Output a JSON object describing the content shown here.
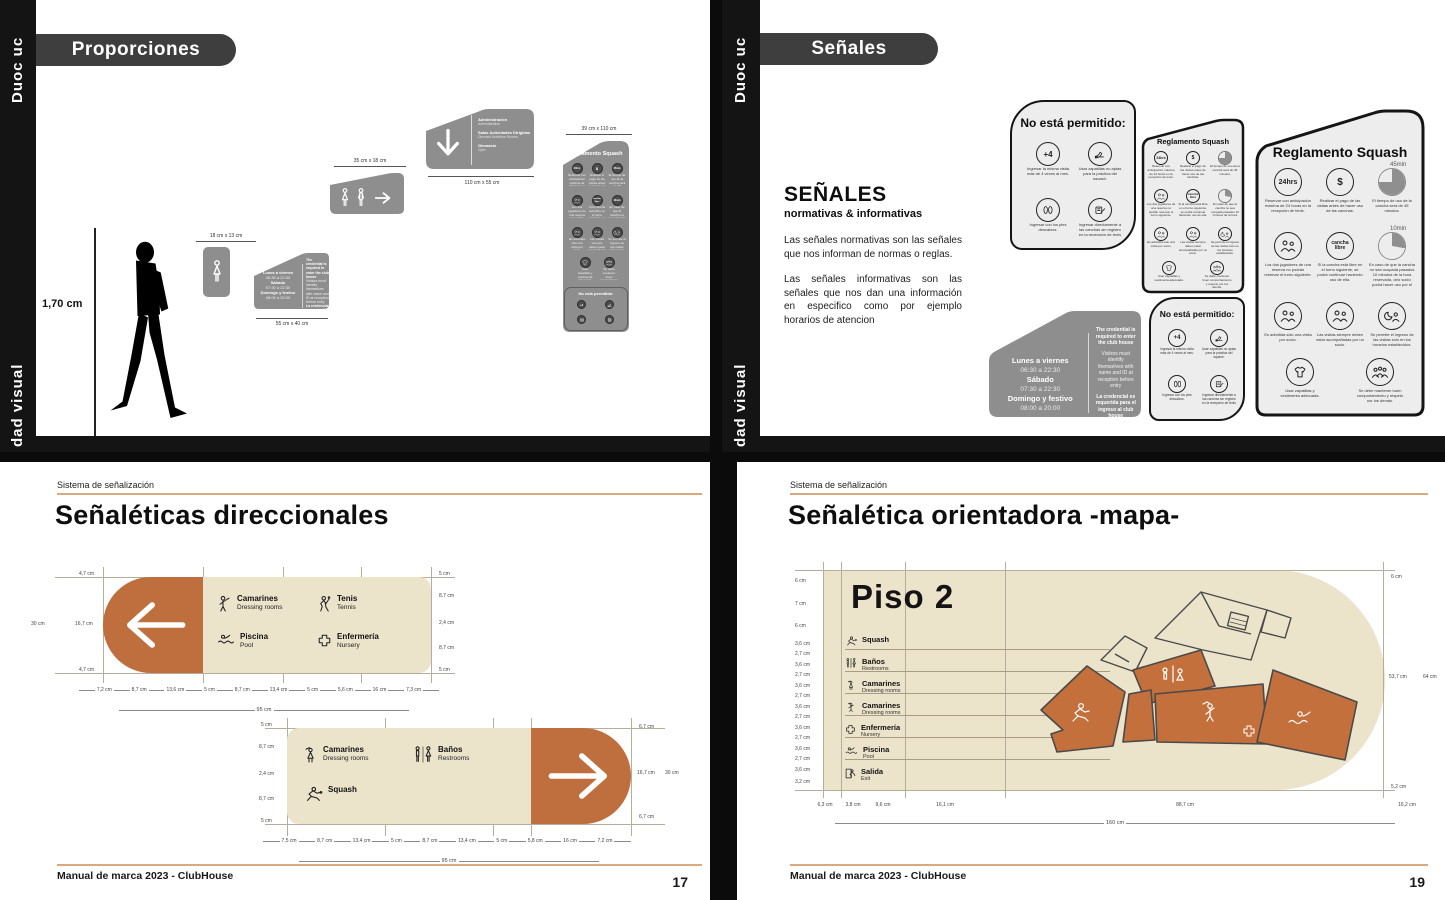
{
  "brand": {
    "logo_vertical": "Duoc uc",
    "spine_text": "dad visual",
    "section_label": "Sistema de señalización",
    "footer_text": "Manual de marca 2023 - ClubHouse"
  },
  "colors": {
    "accent_orange": "#bf6f3d",
    "cream": "#ece3cb",
    "sign_gray": "#8e8e8e",
    "light_sign": "#ededed",
    "rule_orange": "#dca87d",
    "ink": "#111111"
  },
  "proporciones": {
    "header": "Proporciones",
    "person_height": "1,70 cm",
    "sign_women": {
      "dim": "18 cm x 13 cm"
    },
    "sign_schedule": {
      "dim": "55 cm x 40 cm"
    },
    "sign_wc": {
      "dim": "35 cm x 18 cm"
    },
    "sign_directory": {
      "dim": "110 cm x 55 cm",
      "items": [
        {
          "es": "Administración",
          "en": "Administration"
        },
        {
          "es": "Salas Actividades Dirigidas",
          "en": "Directed Activities Rooms"
        },
        {
          "es": "Gimnasio",
          "en": "Gym"
        }
      ]
    },
    "sign_reglamento": {
      "dim": "39 cm x  110 cm"
    }
  },
  "senales": {
    "header": "Señales",
    "title": "SEÑALES",
    "subtitle": "normativas & informativas",
    "p1": "Las señales normativas son las señales que nos informan de normas o reglas.",
    "p2": "Las señales informativas son las señales que nos dan una información en especifico como por ejemplo horarios de atencion",
    "no_permitido": {
      "title": "No está permitido:",
      "items": [
        {
          "glyph": "+4",
          "caption": "Ingresar la misma visita más de 4 veces al mes."
        },
        {
          "glyph": "",
          "caption": "Usar zapatillas no aptas para la práctica del squash."
        },
        {
          "glyph": "",
          "caption": "Ingresar con los pies descalzos."
        },
        {
          "glyph": "",
          "caption": "Ingresar directamente a las canchas sin registro en la recepción de tenis y squash."
        }
      ]
    },
    "reglamento": {
      "title": "Reglamento Squash",
      "rules": [
        {
          "glyph": "24hrs",
          "caption": "Reservar con anticipación máxima de 24 horas en la recepción de tenis."
        },
        {
          "glyph": "$",
          "caption": "Realizar el pago de las visitas antes de hacer uso de las canchas."
        },
        {
          "glyph": "45min",
          "caption": "El tiempo de uso de la cancha será de 45 minutos."
        },
        {
          "glyph": "",
          "caption": "Los dos jugadores de una reserva no podrán reservar el turno siguiente."
        },
        {
          "glyph": "cancha libre",
          "caption": "Si la cancha está libre en el turno siguiente, se podrá continuar haciendo uso de ella."
        },
        {
          "glyph": "10min",
          "caption": "En caso de que la cancha no sea ocupada pasados 10 minutos de la hora reservada, otro socio podrá hacer uso por el tiempo restante."
        },
        {
          "glyph": "",
          "caption": "Es admitida sólo una visita por socio."
        },
        {
          "glyph": "",
          "caption": "Las visitas siempre deben estar acompañadas por un socio."
        },
        {
          "glyph": "",
          "caption": "Se permite el ingreso de las visitas sólo en los horarios establecidos."
        },
        {
          "glyph": "",
          "caption": "Usar zapatillas y vestimenta adecuada."
        },
        {
          "glyph": "",
          "caption": "Se debe mantener buen comportamiento y respeto por los demás."
        }
      ]
    },
    "schedule": {
      "rows": [
        {
          "day": "Lunes a viernes",
          "time": "06:30 a 22:30"
        },
        {
          "day": "Sábado",
          "time": "07:30 a 22:30"
        },
        {
          "day": "Domingo y festivo",
          "time": "08:00 a 20:00"
        }
      ],
      "credential": [
        {
          "text": "The credential is required to enter the club house"
        },
        {
          "text": "Visitors must identify themselves with name and ID at reception before entry"
        },
        {
          "text": "La credencial es requerida para el ingreso al club house"
        },
        {
          "text": "Visitas deben identificarse con nombre y rut en recepción antes del ingreso"
        }
      ]
    }
  },
  "direccionales": {
    "title": "Señaléticas direccionales",
    "page_number": "17",
    "sign1": {
      "items": [
        {
          "label": "Camarines",
          "sub": "Dressing rooms"
        },
        {
          "label": "Tenis",
          "sub": "Tennis"
        },
        {
          "label": "Piscina",
          "sub": "Pool"
        },
        {
          "label": "Enfermería",
          "sub": "Nursery"
        }
      ],
      "height": "30 cm",
      "left": [
        "4,7 cm",
        "16,7 cm",
        "4,7 cm"
      ],
      "right": [
        "5 cm",
        "8,7 cm",
        "2,4 cm",
        "8,7 cm",
        "5 cm"
      ],
      "bottom": [
        "7,2 cm",
        "8,7 cm",
        "13,6 cm",
        "5 cm",
        "8,7 cm",
        "13,4 cm",
        "5 cm",
        "5,6 cm",
        "16 cm",
        "7,3 cm"
      ],
      "total": "95 cm"
    },
    "sign2": {
      "items": [
        {
          "label": "Camarines",
          "sub": "Dressing rooms"
        },
        {
          "label": "Baños",
          "sub": "Restrooms"
        },
        {
          "label": "Squash",
          "sub": ""
        }
      ],
      "height": "30 cm",
      "left": [
        "5 cm",
        "8,7 cm",
        "2,4 cm",
        "8,7 cm",
        "5 cm"
      ],
      "right": [
        "6,7 cm",
        "16,7 cm",
        "6,7 cm"
      ],
      "bottom": [
        "7,5 cm",
        "8,7 cm",
        "13,4 cm",
        "5 cm",
        "8,7 cm",
        "13,4 cm",
        "5 cm",
        "5,8 cm",
        "16 cm",
        "7,2 cm"
      ],
      "total": "95 cm"
    }
  },
  "mapa": {
    "title": "Señalética orientadora -mapa-",
    "page_number": "19",
    "map_title": "Piso 2",
    "legend": [
      {
        "label": "Squash",
        "sub": ""
      },
      {
        "label": "Baños",
        "sub": "Restrooms"
      },
      {
        "label": "Camarines",
        "sub": "Dressing rooms"
      },
      {
        "label": "Camarines",
        "sub": "Dressing rooms"
      },
      {
        "label": "Enfermería",
        "sub": "Nursery"
      },
      {
        "label": "Piscina",
        "sub": "Pool"
      },
      {
        "label": "Salida",
        "sub": "Exit"
      }
    ],
    "left_meas": [
      "6 cm",
      "7 cm",
      "6 cm",
      "3,6 cm",
      "2,7 cm",
      "3,6 cm",
      "2,7 cm",
      "3,6 cm",
      "2,7 cm",
      "3,6 cm",
      "2,7 cm",
      "3,6 cm",
      "2,7 cm",
      "3,6 cm",
      "2,7 cm",
      "3,6 cm",
      "3,2 cm"
    ],
    "right_meas": [
      "6 cm",
      "53,7 cm",
      "5,2 cm"
    ],
    "right_total": "64 cm",
    "bottom_meas": [
      "6,3 cm",
      "3,8 cm",
      "9,6 cm",
      "16,1 cm",
      "88,7 cm",
      "16,2 cm"
    ],
    "bottom_total": "160 cm"
  }
}
